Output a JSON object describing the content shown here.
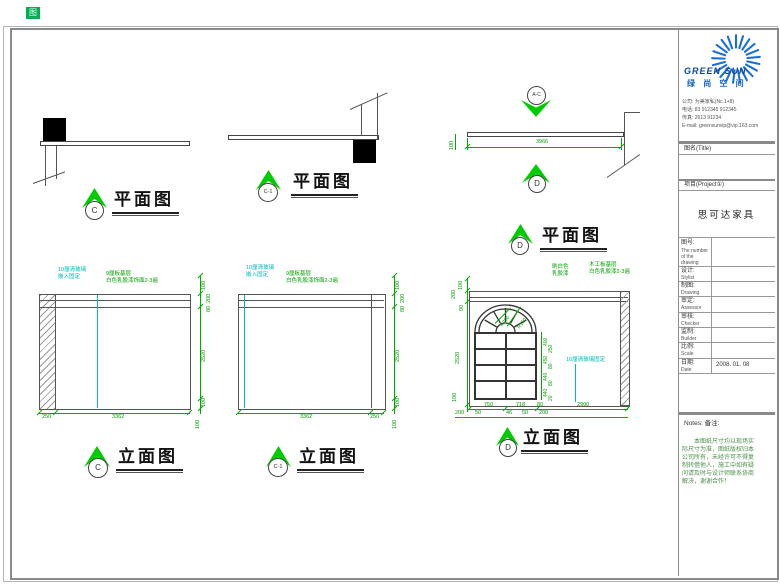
{
  "corner_mark": "图",
  "sheet": {
    "plan_c": {
      "marker": "C",
      "title": "平面图"
    },
    "plan_c1": {
      "marker": "C-1",
      "title": "平面图"
    },
    "plan_d": {
      "marker": "D",
      "title": "平面图",
      "top_marker": "A-C",
      "dim_width": "3966",
      "dim_left": "100"
    },
    "elev_c": {
      "marker": "C",
      "title": "立面图",
      "note_cyan": [
        "10厘清玻璃",
        "嵌入固定"
      ],
      "note_green": [
        "9厘板基层",
        "白色乳胶漆饰面2-3遍"
      ],
      "dims_right": [
        "100",
        "200",
        "80",
        "2520",
        "100"
      ],
      "dims_bottom": [
        "250",
        "3362"
      ],
      "dim_corner": "100"
    },
    "elev_c1": {
      "marker": "C-1",
      "title": "立面图",
      "note_cyan": [
        "10厘清玻璃",
        "嵌入固定"
      ],
      "note_green": [
        "9厘板基层",
        "白色乳胶漆饰面2-3遍"
      ],
      "dims_right": [
        "100",
        "200",
        "80",
        "2520",
        "100"
      ],
      "dims_bottom": [
        "3362",
        "250"
      ],
      "dim_corner": "100"
    },
    "elev_d": {
      "marker": "D",
      "title": "立面图",
      "note_green_1": [
        "刷白色",
        "乳胶漆"
      ],
      "note_green_2": [
        "木工板基层",
        "白色乳胶漆2-3遍"
      ],
      "note_cyan": "10厘清玻璃固定",
      "radius_labels": [
        "R750",
        "R150"
      ],
      "dims_left": [
        "100",
        "200",
        "90",
        "2520",
        "100"
      ],
      "dims_window": [
        "400",
        "250",
        "450",
        "80",
        "440",
        "80",
        "440",
        "20"
      ],
      "dims_bottom_1": [
        "750",
        "718",
        "80",
        "2900"
      ],
      "dims_bottom_2": [
        "200",
        "50",
        "46",
        "50",
        "200"
      ]
    }
  },
  "title_block": {
    "brand": "GREEN SUN",
    "brand_cn": "绿 尚 空 间",
    "company_lines": [
      "公司: 为美家私(Nc.1+8)",
      "电话: 83 912345  912345",
      "传真: 2613 91234",
      "E-mail: greensunvip@vip.163.com"
    ],
    "title_label": "图名(Title)",
    "project_label": "项目(Project①)",
    "project_name": "思可达家具",
    "rows": [
      {
        "label": "图号:",
        "sub1": "The number",
        "sub2": "of the",
        "sub3": "drawing",
        "value": ""
      },
      {
        "label": "设计:",
        "sub1": "Stylist",
        "value": ""
      },
      {
        "label": "制图:",
        "sub1": "Drawing",
        "value": ""
      },
      {
        "label": "审定:",
        "sub1": "Assessor",
        "value": ""
      },
      {
        "label": "审核:",
        "sub1": "Checker",
        "value": ""
      },
      {
        "label": "监制:",
        "sub1": "Builder",
        "value": ""
      },
      {
        "label": "比例:",
        "sub1": "Scale",
        "value": ""
      },
      {
        "label": "日期:",
        "sub1": "Date",
        "value": "2008. 01. 08"
      }
    ],
    "notes_label": "Notes: 备注:",
    "notes_lines": [
      "　　本图纸尺寸均以现场实",
      "际尺寸为准，图纸版权归本",
      "公司所有，未经许可不得复",
      "制转借他人，施工中如有疑",
      "问请及时与设计师联系协商",
      "解决，谢谢合作！"
    ]
  }
}
